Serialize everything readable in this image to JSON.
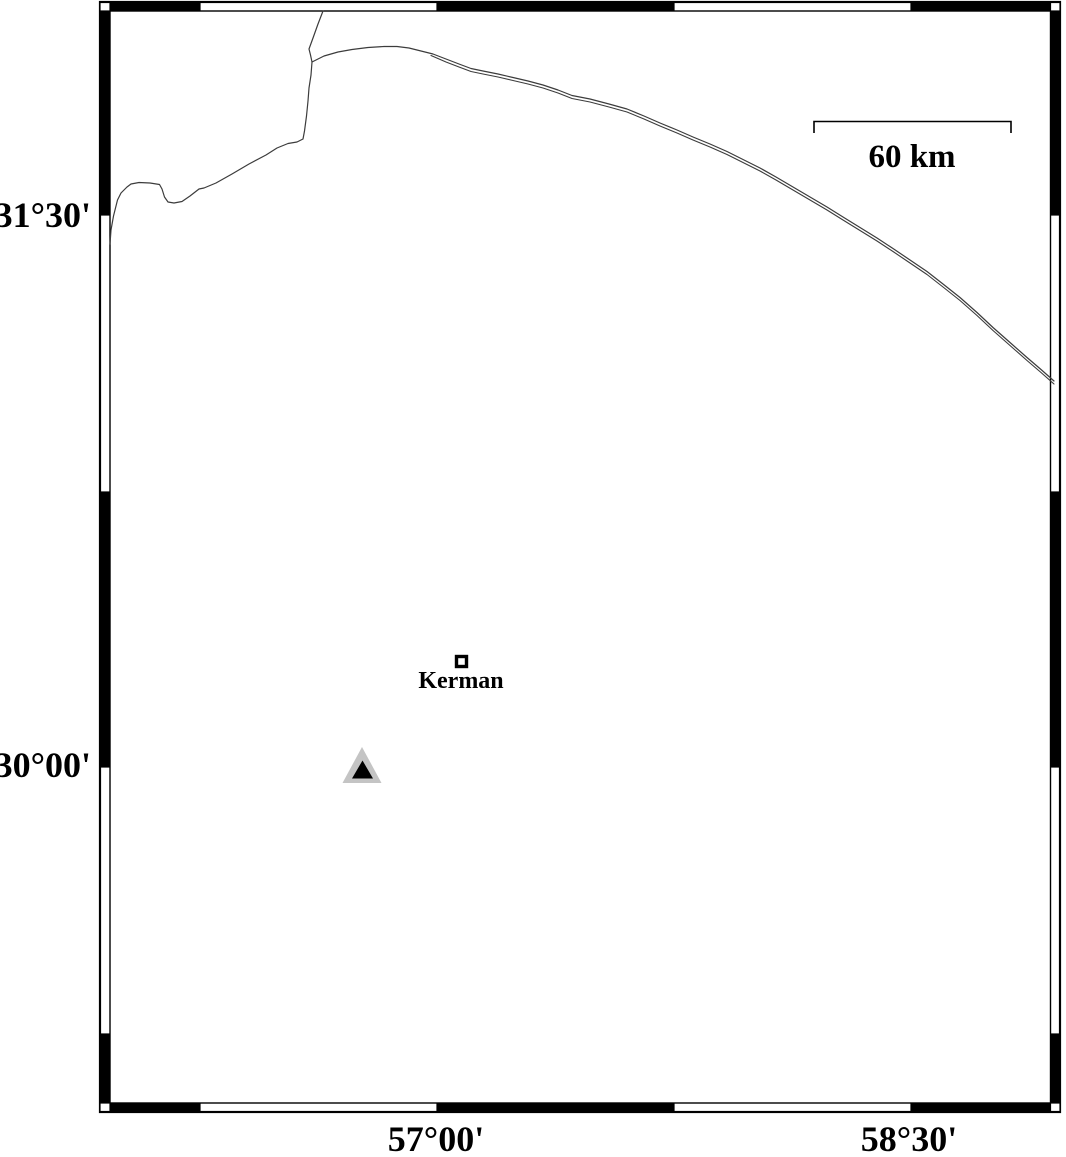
{
  "frame": {
    "lat_ticks": [
      {
        "label": "31°30'"
      },
      {
        "label": "30°00'"
      }
    ],
    "lon_ticks": [
      {
        "label": "57°00'"
      },
      {
        "label": "58°30'"
      }
    ]
  },
  "scale_bar": {
    "label": "60 km"
  },
  "markers": {
    "city": {
      "label": "Kerman",
      "symbol": "open-square"
    },
    "station": {
      "symbol": "triangle"
    }
  },
  "colors": {
    "ink": "#000000",
    "line": "#3c3c3c",
    "station_fill": "#c4c4c4",
    "station_core": "#000000",
    "background": "#ffffff"
  }
}
